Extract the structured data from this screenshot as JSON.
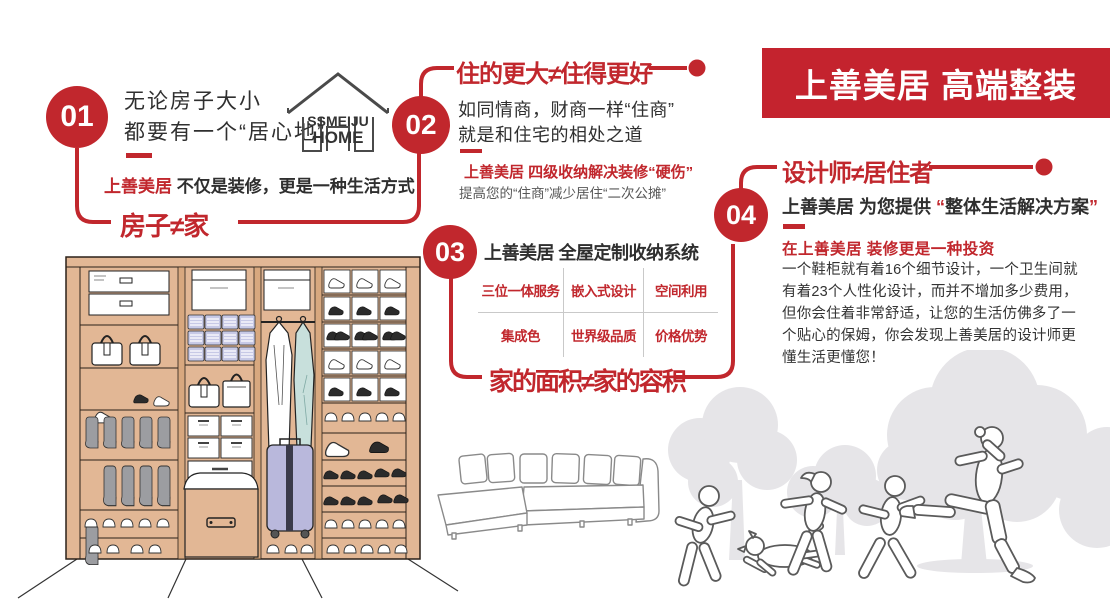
{
  "banner": {
    "title": "上善美居 高端整装"
  },
  "logo": {
    "line1": "SSMEIJU",
    "line2": "HOME"
  },
  "colors": {
    "primary_red": "#C1272D",
    "banner_red": "#C4232E",
    "dark_text": "#2F2F2F",
    "gray_text": "#575757",
    "wardrobe_tan": "#E2B795",
    "bin_lavender": "#C7C9E6",
    "suit_blue": "#C8E0DC",
    "suitcase_lavender": "#B9B8DC",
    "tree_gray": "#E6E5E8"
  },
  "sections": {
    "s1": {
      "number": "01",
      "line1": "无论房子大小",
      "line2": "都要有一个“居心地”",
      "brand": "上善美居",
      "slogan_rest": "不仅是装修，更是一种生活方式",
      "label": "房子≠家"
    },
    "s2": {
      "number": "02",
      "title": "住的更大≠住得更好",
      "line1": "如同情商，财商一样“住商”",
      "line2": "就是和住宅的相处之道",
      "red_line": "上善美居 四级收纳解决装修“硬伤”",
      "gray_line": "提高您的“住商”减少居住“二次公摊”"
    },
    "s3": {
      "number": "03",
      "heading": "上善美居 全屋定制收纳系统",
      "grid": [
        [
          "三位一体服务",
          "嵌入式设计",
          "空间利用"
        ],
        [
          "集成色",
          "世界级品质",
          "价格优势"
        ]
      ],
      "label": "家的面积≠家的容积"
    },
    "s4": {
      "number": "04",
      "title": "设计师≠居住者",
      "lead_black": "上善美居 为您提供",
      "quote_open": "“",
      "lead_quoted": "整体生活解决方案",
      "quote_close": "”",
      "red_line": "在上善美居 装修更是一种投资",
      "paragraph": "一个鞋柜就有着16个细节设计，一个卫生间就有着23个人性化设计，而并不增加多少费用，但你会住着非常舒适，让您的生活仿佛多了一个贴心的保姆，你会发现上善美居的设计师更懂生活更懂您！"
    }
  }
}
